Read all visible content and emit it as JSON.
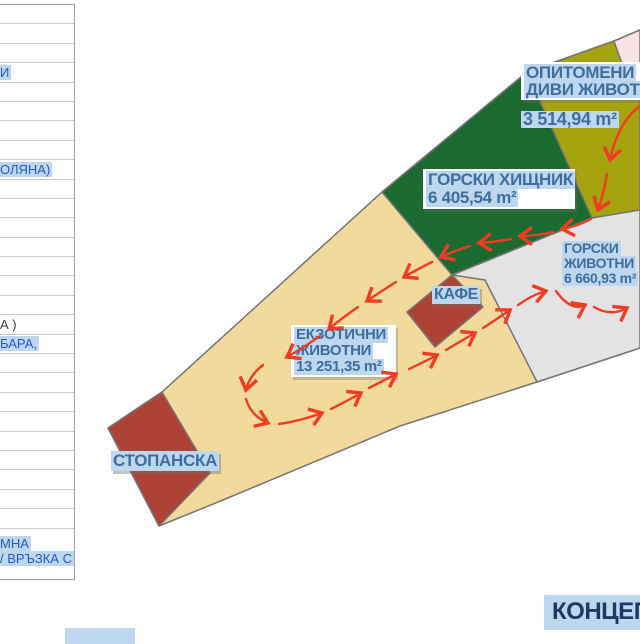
{
  "title": {
    "text": "КОНЦЕП"
  },
  "colors": {
    "tan": "#F2D99C",
    "green": "#1B6A2F",
    "olive": "#A6A40E",
    "pink": "#F9E1E4",
    "gray": "#E3E3E3",
    "brick": "#AE4237",
    "outline": "#757575",
    "path_red": "#F23B25",
    "label_text": "#3E6D9E",
    "highlight": "#BDD7EE",
    "sidebar_text": "#2857C8",
    "title_text": "#1F3864"
  },
  "map": {
    "labels": {
      "opitomeni": {
        "line1": "ОПИТОМЕНИ",
        "line2": "ДИВИ ЖИВОТНИ",
        "area": "3 514,94 m²"
      },
      "gorski_hishtnik": {
        "line1": "ГОРСКИ ХИЩНИК",
        "area": "6 405,54 m²"
      },
      "gorski_zhivotni": {
        "line1": "ГОРСКИ",
        "line2": "ЖИВОТНИ",
        "area": "6 660,93 m²"
      },
      "kafe": {
        "label": "КАФЕ"
      },
      "ekzotichni": {
        "line1": "ЕКЗОТИЧНИ",
        "line2": "ЖИВОТНИ",
        "area": "13 251,35 m²"
      },
      "stopanska": {
        "label": "СТОПАНСКА"
      }
    }
  },
  "sidebar": {
    "rows": [
      {
        "text": ""
      },
      {
        "text": ""
      },
      {
        "text": ""
      },
      {
        "text": "И",
        "highlighted": true
      },
      {
        "text": ""
      },
      {
        "text": ""
      },
      {
        "text": ""
      },
      {
        "text": ""
      },
      {
        "text": "ОЛЯНА)",
        "highlighted": true
      },
      {
        "text": ""
      },
      {
        "text": ""
      },
      {
        "text": ""
      },
      {
        "text": ""
      },
      {
        "text": ""
      },
      {
        "text": ""
      },
      {
        "text": ""
      },
      {
        "text": "А )",
        "highlighted": false
      },
      {
        "text": "БАРА,",
        "highlighted": true
      },
      {
        "text": ""
      },
      {
        "text": ""
      },
      {
        "text": ""
      },
      {
        "text": ""
      },
      {
        "text": ""
      },
      {
        "text": ""
      },
      {
        "text": ""
      },
      {
        "text": ""
      },
      {
        "text": ""
      },
      {
        "lines": [
          "МНА",
          "/ ВРЪЗКА С"
        ],
        "highlighted": true,
        "tall": true
      }
    ]
  }
}
